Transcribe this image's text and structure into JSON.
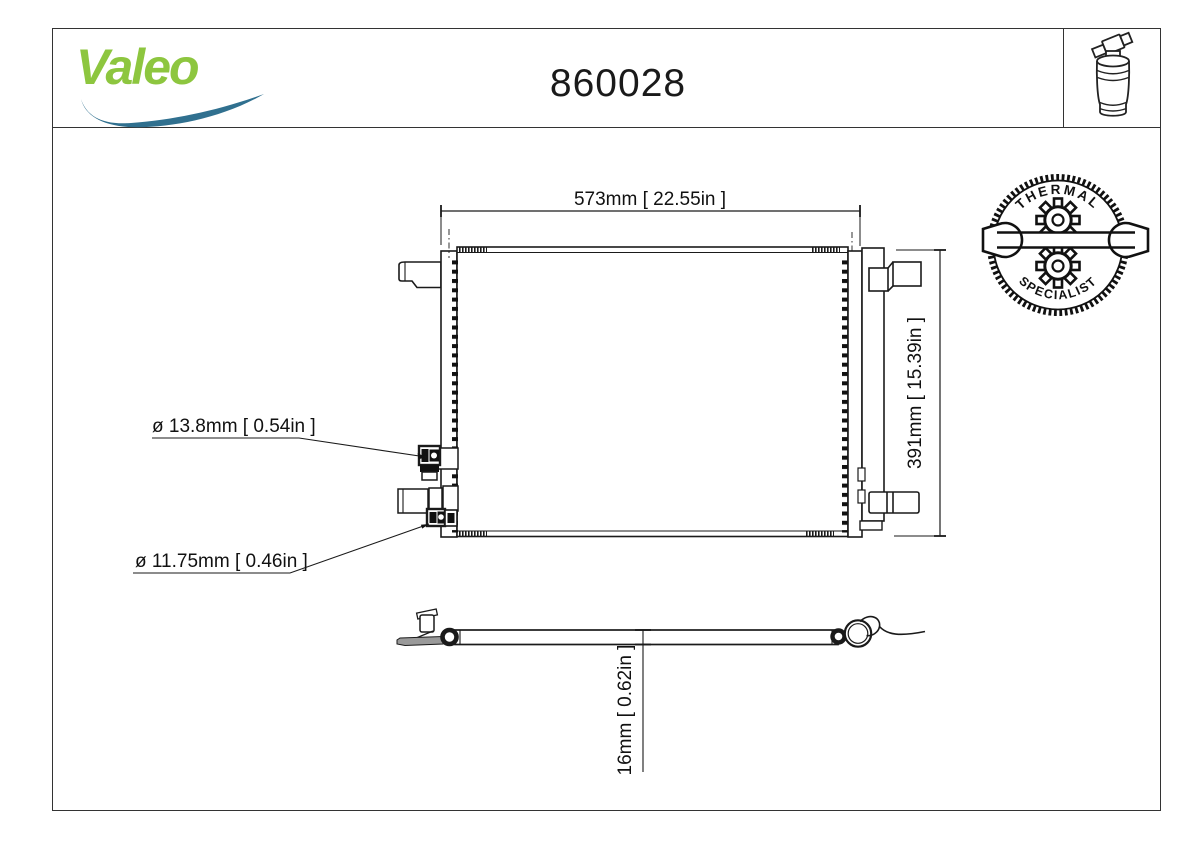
{
  "header": {
    "brand": "Valeo",
    "part_number": "860028"
  },
  "badge": {
    "top_text": "THERMAL",
    "bottom_text": "SPECIALIST"
  },
  "dimensions": {
    "width": "573mm [ 22.55in ]",
    "height": "391mm [ 15.39in ]",
    "upper_port": "ø 13.8mm [ 0.54in ]",
    "lower_port": "ø 11.75mm [ 0.46in ]",
    "core_depth": "16mm [ 0.62in ]"
  },
  "colors": {
    "brand_green": "#8DC63F",
    "brand_blue": "#30708F",
    "line": "#1a1a1a"
  },
  "icons": {
    "valeo_swoosh_icon": "blue swoosh under brand wordmark",
    "receiver_drier_icon": "outline drawing of receiver-drier bottle",
    "thermal_specialist_stamp": "serrated circular stamp with gears",
    "wrench_icon": "open-end wrench across stamp"
  }
}
